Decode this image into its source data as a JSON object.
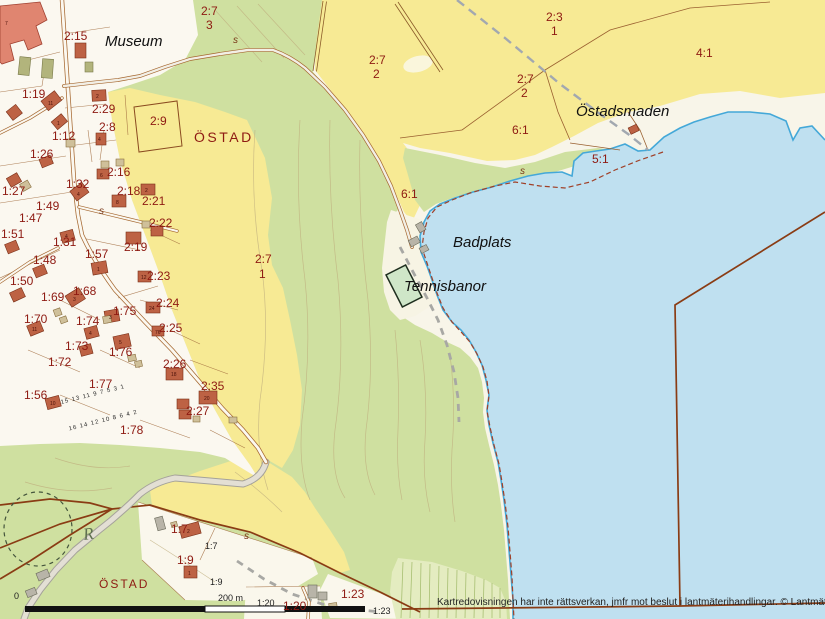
{
  "map": {
    "colors": {
      "water": "#bfe0f0",
      "field_yellow": "#f7ea94",
      "forest_green": "#cfe0a0",
      "open_land": "#f8f5e9",
      "building_red": "#bd6244",
      "building_salmon": "#e08570",
      "boundary_brown": "#8a3c14",
      "parcel_text_red": "#8e1a12",
      "coast_blue": "#44a8d8"
    },
    "scale_bar": {
      "zero_label": "0",
      "distance_label": "200 m"
    },
    "monument_symbol": "R",
    "labels": [
      {
        "t": "2:7",
        "x": 201,
        "y": 5,
        "c": "pr"
      },
      {
        "t": "3",
        "x": 206,
        "y": 19,
        "c": "pr"
      },
      {
        "t": "2:15",
        "x": 64,
        "y": 30,
        "c": "pr"
      },
      {
        "t": "2:3",
        "x": 546,
        "y": 11,
        "c": "pr"
      },
      {
        "t": "1",
        "x": 551,
        "y": 25,
        "c": "pr"
      },
      {
        "t": "2:7",
        "x": 369,
        "y": 54,
        "c": "pr"
      },
      {
        "t": "2",
        "x": 373,
        "y": 68,
        "c": "pr"
      },
      {
        "t": "2:7",
        "x": 517,
        "y": 73,
        "c": "pr"
      },
      {
        "t": "2",
        "x": 521,
        "y": 87,
        "c": "pr"
      },
      {
        "t": "4:1",
        "x": 696,
        "y": 47,
        "c": "pr"
      },
      {
        "t": "6:1",
        "x": 512,
        "y": 124,
        "c": "pr"
      },
      {
        "t": "5:1",
        "x": 592,
        "y": 153,
        "c": "pr"
      },
      {
        "t": "6:1",
        "x": 401,
        "y": 188,
        "c": "pr"
      },
      {
        "t": "2:7",
        "x": 255,
        "y": 253,
        "c": "pr"
      },
      {
        "t": "1",
        "x": 259,
        "y": 268,
        "c": "pr"
      },
      {
        "t": "1:19",
        "x": 22,
        "y": 88,
        "c": "pr"
      },
      {
        "t": "2:29",
        "x": 92,
        "y": 103,
        "c": "pr"
      },
      {
        "t": "2:8",
        "x": 99,
        "y": 121,
        "c": "pr"
      },
      {
        "t": "1:12",
        "x": 52,
        "y": 130,
        "c": "pr"
      },
      {
        "t": "2:9",
        "x": 150,
        "y": 115,
        "c": "pr"
      },
      {
        "t": "1:26",
        "x": 30,
        "y": 148,
        "c": "pr"
      },
      {
        "t": "2:16",
        "x": 107,
        "y": 166,
        "c": "pr"
      },
      {
        "t": "1:32",
        "x": 66,
        "y": 178,
        "c": "pr"
      },
      {
        "t": "1:27",
        "x": 2,
        "y": 185,
        "c": "pr"
      },
      {
        "t": "2:18",
        "x": 117,
        "y": 185,
        "c": "pr"
      },
      {
        "t": "2:21",
        "x": 142,
        "y": 195,
        "c": "pr"
      },
      {
        "t": "1:49",
        "x": 36,
        "y": 200,
        "c": "pr"
      },
      {
        "t": "1:47",
        "x": 19,
        "y": 212,
        "c": "pr"
      },
      {
        "t": "2:22",
        "x": 149,
        "y": 217,
        "c": "pr"
      },
      {
        "t": "1:51",
        "x": 1,
        "y": 228,
        "c": "pr"
      },
      {
        "t": "1:31",
        "x": 53,
        "y": 236,
        "c": "pr"
      },
      {
        "t": "2:19",
        "x": 124,
        "y": 241,
        "c": "pr"
      },
      {
        "t": "1:57",
        "x": 85,
        "y": 248,
        "c": "pr"
      },
      {
        "t": "1:48",
        "x": 33,
        "y": 254,
        "c": "pr"
      },
      {
        "t": "1:50",
        "x": 10,
        "y": 275,
        "c": "pr"
      },
      {
        "t": "2:23",
        "x": 147,
        "y": 270,
        "c": "pr"
      },
      {
        "t": "1:69",
        "x": 41,
        "y": 291,
        "c": "pr"
      },
      {
        "t": "1:68",
        "x": 73,
        "y": 285,
        "c": "pr"
      },
      {
        "t": "2:24",
        "x": 156,
        "y": 297,
        "c": "pr"
      },
      {
        "t": "1:70",
        "x": 24,
        "y": 313,
        "c": "pr"
      },
      {
        "t": "1:75",
        "x": 113,
        "y": 305,
        "c": "pr"
      },
      {
        "t": "1:74",
        "x": 76,
        "y": 315,
        "c": "pr"
      },
      {
        "t": "2:25",
        "x": 159,
        "y": 322,
        "c": "pr"
      },
      {
        "t": "1:73",
        "x": 65,
        "y": 340,
        "c": "pr"
      },
      {
        "t": "1:76",
        "x": 109,
        "y": 346,
        "c": "pr"
      },
      {
        "t": "1:72",
        "x": 48,
        "y": 356,
        "c": "pr"
      },
      {
        "t": "2:26",
        "x": 163,
        "y": 358,
        "c": "pr"
      },
      {
        "t": "1:77",
        "x": 89,
        "y": 378,
        "c": "pr"
      },
      {
        "t": "2:35",
        "x": 201,
        "y": 380,
        "c": "pr"
      },
      {
        "t": "1:56",
        "x": 24,
        "y": 389,
        "c": "pr"
      },
      {
        "t": "2:27",
        "x": 186,
        "y": 405,
        "c": "pr"
      },
      {
        "t": "1:78",
        "x": 120,
        "y": 424,
        "c": "pr"
      },
      {
        "t": "1:7",
        "x": 171,
        "y": 523,
        "c": "pr"
      },
      {
        "t": "1:9",
        "x": 177,
        "y": 554,
        "c": "pr"
      },
      {
        "t": "1:20",
        "x": 283,
        "y": 600,
        "c": "pr"
      },
      {
        "t": "1:23",
        "x": 341,
        "y": 588,
        "c": "pr"
      },
      {
        "t": "1:7",
        "x": 205,
        "y": 542,
        "c": "bk"
      },
      {
        "t": "1:9",
        "x": 210,
        "y": 578,
        "c": "bk"
      },
      {
        "t": "1:20",
        "x": 257,
        "y": 599,
        "c": "bk"
      },
      {
        "t": "1:23",
        "x": 373,
        "y": 607,
        "c": "bk"
      },
      {
        "t": "0",
        "x": 14,
        "y": 592,
        "c": "bk"
      },
      {
        "t": "200 m",
        "x": 218,
        "y": 594,
        "c": "bk"
      },
      {
        "t": "15 13 11 9 7 5 3 1",
        "x": 60,
        "y": 392,
        "c": "tiny",
        "r": -14
      },
      {
        "t": "16 14 12 10 8 6 4 2",
        "x": 68,
        "y": 418,
        "c": "tiny",
        "r": -14
      },
      {
        "t": "s",
        "x": 233,
        "y": 36,
        "c": "sm"
      },
      {
        "t": "s",
        "x": 99,
        "y": 207,
        "c": "sm"
      },
      {
        "t": "s",
        "x": 520,
        "y": 167,
        "c": "sm"
      },
      {
        "t": "s",
        "x": 244,
        "y": 532,
        "c": "sm"
      },
      {
        "t": "Museum",
        "x": 105,
        "y": 34,
        "c": "pl"
      },
      {
        "t": "Östadsmaden",
        "x": 576,
        "y": 104,
        "c": "pl"
      },
      {
        "t": "Badplats",
        "x": 453,
        "y": 235,
        "c": "pl"
      },
      {
        "t": "Tennisbanor",
        "x": 404,
        "y": 279,
        "c": "pl"
      },
      {
        "t": "ÖSTAD",
        "x": 194,
        "y": 130,
        "c": "town"
      },
      {
        "t": "ÖSTAD",
        "x": 99,
        "y": 578,
        "c": "town2"
      },
      {
        "t": "Kartredovisningen har inte rättsverkan, jmfr mot beslut i lantmäterihandlingar. © Lantmäteriet",
        "x": 437,
        "y": 598,
        "c": "copy"
      }
    ],
    "building_numbers": [
      {
        "t": "7",
        "x": 5,
        "y": 20
      },
      {
        "t": "11",
        "x": 48,
        "y": 100
      },
      {
        "t": "2",
        "x": 96,
        "y": 93
      },
      {
        "t": "1",
        "x": 57,
        "y": 120
      },
      {
        "t": "4",
        "x": 98,
        "y": 136
      },
      {
        "t": "6",
        "x": 100,
        "y": 172
      },
      {
        "t": "4",
        "x": 77,
        "y": 191
      },
      {
        "t": "2",
        "x": 145,
        "y": 187
      },
      {
        "t": "8",
        "x": 116,
        "y": 199
      },
      {
        "t": "4",
        "x": 65,
        "y": 233
      },
      {
        "t": "1",
        "x": 97,
        "y": 266
      },
      {
        "t": "3",
        "x": 73,
        "y": 296
      },
      {
        "t": "12",
        "x": 141,
        "y": 274
      },
      {
        "t": "11",
        "x": 32,
        "y": 326
      },
      {
        "t": "3",
        "x": 109,
        "y": 314
      },
      {
        "t": "24",
        "x": 149,
        "y": 305
      },
      {
        "t": "4",
        "x": 89,
        "y": 330
      },
      {
        "t": "76",
        "x": 155,
        "y": 329
      },
      {
        "t": "5",
        "x": 119,
        "y": 339
      },
      {
        "t": "18",
        "x": 171,
        "y": 371
      },
      {
        "t": "20",
        "x": 204,
        "y": 395
      },
      {
        "t": "10",
        "x": 50,
        "y": 400
      },
      {
        "t": "2",
        "x": 187,
        "y": 528
      },
      {
        "t": "1",
        "x": 188,
        "y": 570
      }
    ]
  }
}
